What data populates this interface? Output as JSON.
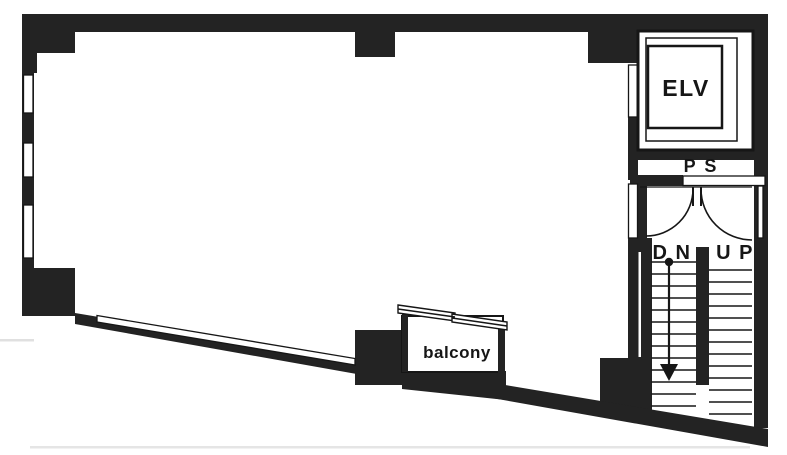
{
  "figure": {
    "type": "architectural-floor-plan",
    "labels": {
      "elevator": "ELV",
      "pipe_shaft": "P S",
      "stair_down": "D N",
      "stair_up": "U P",
      "balcony": "balcony"
    },
    "colors": {
      "wall": "#232323",
      "line": "#161616",
      "paper": "#ffffff"
    }
  }
}
